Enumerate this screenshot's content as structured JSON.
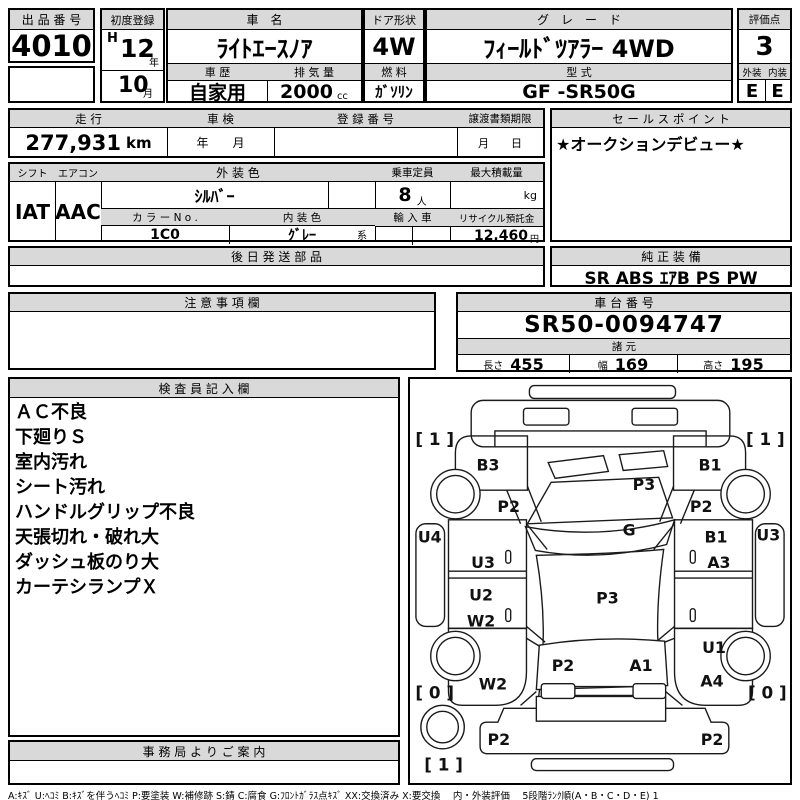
{
  "auction_no": {
    "label": "出 品 番 号",
    "value": "4010"
  },
  "first_reg": {
    "label": "初度登録",
    "era": "H",
    "year": "12",
    "year_unit": "年",
    "month": "10",
    "month_unit": "月"
  },
  "car_name": {
    "label": "車　名",
    "value": "ﾗｲﾄｴｰｽﾉｱ"
  },
  "history": {
    "label": "車 歴",
    "value": "自家用"
  },
  "displacement": {
    "label": "排 気 量",
    "value": "2000",
    "unit": "cc"
  },
  "door": {
    "label": "ドア形状",
    "value": "4W"
  },
  "fuel": {
    "label": "燃 料",
    "value": "ｶﾞｿﾘﾝ"
  },
  "grade": {
    "label": "グ　レ　ー　ド",
    "value": "ﾌｨｰﾙﾄﾞﾂｱﾗｰ 4WD"
  },
  "model_code": {
    "label": "型 式",
    "value": "GF -SR50G"
  },
  "score": {
    "label": "評価点",
    "value": "3"
  },
  "exterior": {
    "label": "外装",
    "value": "E"
  },
  "interior": {
    "label": "内装",
    "value": "E"
  },
  "mileage": {
    "label": "走 行",
    "value": "277,931",
    "unit": "km"
  },
  "shaken": {
    "label": "車 検",
    "value": "年　　月"
  },
  "reg_no": {
    "label": "登 録 番 号",
    "value": ""
  },
  "transfer": {
    "label": "譲渡書類期限",
    "value": "月　　日"
  },
  "sales_point": {
    "label": "セ ー ル ス ポ イ ン ト",
    "value": "★オークションデビュー★"
  },
  "shift": {
    "label": "シフト",
    "value": "IAT"
  },
  "aircon": {
    "label": "エアコン",
    "value": "AAC"
  },
  "ext_color": {
    "label": "外 装 色",
    "value": "ｼﾙﾊﾞｰ"
  },
  "capacity": {
    "label": "乗車定員",
    "value": "8",
    "unit": "人"
  },
  "max_load": {
    "label": "最大積載量",
    "value": "",
    "unit": "kg"
  },
  "color_no": {
    "label": "カ ラ ー N o .",
    "value": "1C0"
  },
  "int_color": {
    "label": "内 装 色",
    "value": "ｸﾞﾚｰ",
    "suffix": "系"
  },
  "import_car": {
    "label": "輸 入 車",
    "value": ""
  },
  "recycle": {
    "label": "リサイクル預託金",
    "value": "12,460",
    "unit": "円"
  },
  "later_parts": {
    "label": "後 日 発 送 部 品",
    "value": ""
  },
  "equipment": {
    "label": "純 正 装 備",
    "value": "SR ABS ｴｱB PS PW"
  },
  "caution": {
    "label": "注 意 事 項 欄",
    "value": ""
  },
  "chassis": {
    "label": "車 台 番 号",
    "value": "SR50-0094747"
  },
  "dims": {
    "label": "諸 元",
    "items": [
      {
        "label": "長さ",
        "value": "455"
      },
      {
        "label": "幅",
        "value": "169"
      },
      {
        "label": "高さ",
        "value": "195"
      }
    ]
  },
  "inspector": {
    "label": "検 査 員 記 入 欄",
    "notes": [
      "ＡＣ不良",
      "下廻りＳ",
      "室内汚れ",
      "シート汚れ",
      "ハンドルグリップ不良",
      "天張切れ・破れ大",
      "ダッシュ板のり大",
      "カーテシランプＸ"
    ]
  },
  "office": {
    "label": "事 務 局 よ り ご 案 内",
    "value": ""
  },
  "legend": {
    "text": "A:ｷｽﾞ  U:ﾍｺﾐ  B:ｷｽﾞを伴うﾍｺﾐ  P:要塗装  W:補修跡  S:錆  C:腐食  G:ﾌﾛﾝﾄｶﾞﾗｽ点ｷｽﾞ  XX:交換済み  X:要交換　 内・外装評価 　5段階ﾗﾝｸ順(A・B・C・D・E)  1"
  },
  "colors": {
    "header_bg": "#d9d9d9",
    "border": "#000000"
  },
  "diagram": {
    "labels": [
      {
        "text": "[ 1 ]",
        "x": 25,
        "y": 66,
        "size": 17
      },
      {
        "text": "B3",
        "x": 79,
        "y": 92
      },
      {
        "text": "B1",
        "x": 304,
        "y": 92
      },
      {
        "text": "[ 1 ]",
        "x": 360,
        "y": 66,
        "size": 17
      },
      {
        "text": "P2",
        "x": 100,
        "y": 134
      },
      {
        "text": "P2",
        "x": 295,
        "y": 134
      },
      {
        "text": "P3",
        "x": 237,
        "y": 112
      },
      {
        "text": "G",
        "x": 222,
        "y": 158
      },
      {
        "text": "U4",
        "x": 20,
        "y": 165
      },
      {
        "text": "U3",
        "x": 74,
        "y": 191
      },
      {
        "text": "U2",
        "x": 72,
        "y": 224
      },
      {
        "text": "W2",
        "x": 72,
        "y": 250
      },
      {
        "text": "B1",
        "x": 310,
        "y": 165
      },
      {
        "text": "A3",
        "x": 313,
        "y": 191
      },
      {
        "text": "U3",
        "x": 363,
        "y": 163
      },
      {
        "text": "P3",
        "x": 200,
        "y": 227
      },
      {
        "text": "U1",
        "x": 308,
        "y": 277
      },
      {
        "text": "W2",
        "x": 84,
        "y": 314
      },
      {
        "text": "A4",
        "x": 306,
        "y": 311
      },
      {
        "text": "[ 0 ]",
        "x": 25,
        "y": 323,
        "size": 17
      },
      {
        "text": "[ 0 ]",
        "x": 362,
        "y": 323,
        "size": 17
      },
      {
        "text": "P2",
        "x": 155,
        "y": 295
      },
      {
        "text": "A1",
        "x": 234,
        "y": 295
      },
      {
        "text": "P2",
        "x": 90,
        "y": 370
      },
      {
        "text": "P2",
        "x": 306,
        "y": 370
      },
      {
        "text": "[ 1 ]",
        "x": 34,
        "y": 396,
        "size": 17
      }
    ]
  }
}
